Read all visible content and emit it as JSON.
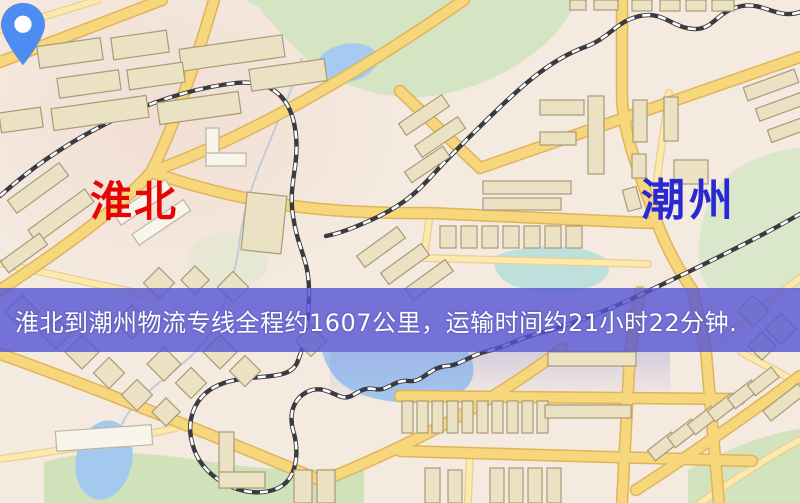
{
  "type": "logistics-route-map",
  "banner": {
    "text": "淮北到潮州物流专线全程约1607公里，运输时间约21小时22分钟.",
    "background_color": "#5454d5",
    "text_color": "#ffffff"
  },
  "markers": {
    "origin": {
      "label": "淮北",
      "label_color": "#e60404",
      "pin_color": "#ec1407",
      "pin_style": "red-teardrop-marker"
    },
    "destination": {
      "label": "潮州",
      "label_color": "#2929d4",
      "pin_color": "#4d8cf2",
      "pin_style": "blue-teardrop-marker"
    }
  },
  "route_info": {
    "origin_city": "淮北",
    "destination_city": "潮州",
    "service": "物流专线",
    "distance_text": "全程约1607公里",
    "duration_text": "运输时间约21小时22分钟"
  },
  "map_palette": {
    "background": "#f4eadf",
    "road_fill": "#f7d77c",
    "road_edge": "#e0b35d",
    "building": "#ebe1c3",
    "park": "#d5e4c2",
    "water": "#a6cbf0",
    "railway": "#3a3a40"
  }
}
